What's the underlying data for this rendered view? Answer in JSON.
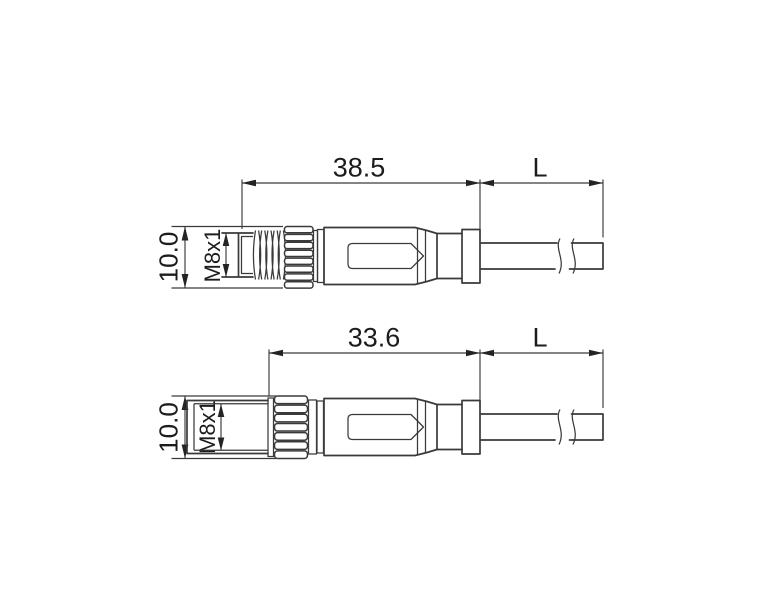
{
  "page": {
    "background": "#ffffff",
    "line_color": "#3a3a3a",
    "text_color": "#1c1c1c"
  },
  "drawings": [
    {
      "name": "M8 male straight connector with cable, side view",
      "dims": {
        "connector_length": "38.5",
        "cable_length": "L",
        "nut_diameter": "10.0",
        "thread": "M8x1"
      }
    },
    {
      "name": "M8 female straight connector with cable, side view",
      "dims": {
        "connector_length": "33.6",
        "cable_length": "L",
        "nut_diameter": "10.0",
        "thread": "M8x1"
      }
    }
  ]
}
